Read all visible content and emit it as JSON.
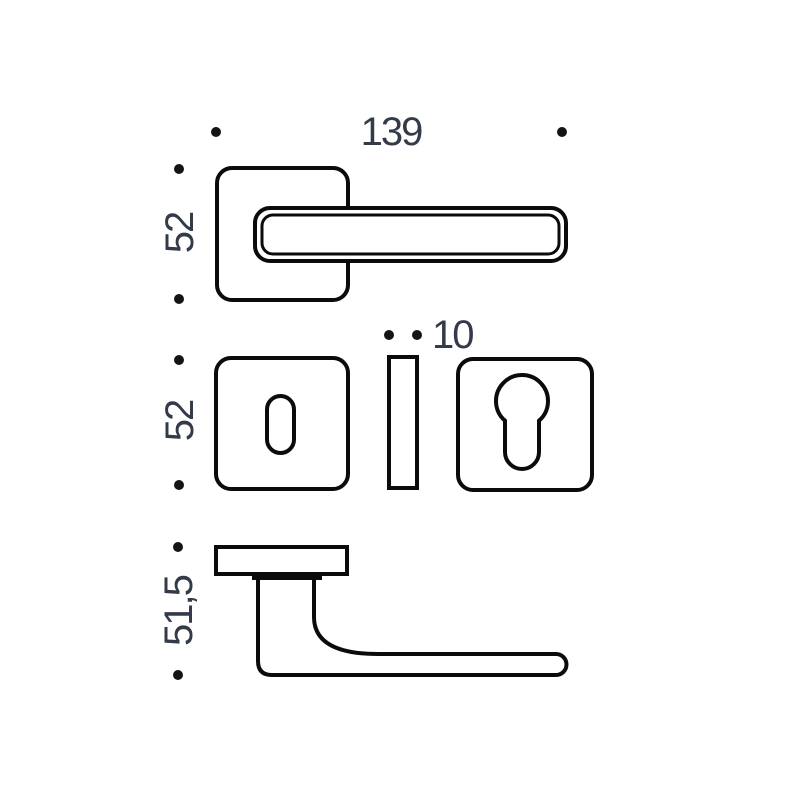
{
  "drawing": {
    "type": "technical-dimension-drawing",
    "subject": "door-lever-handle-with-square-rosette-and-escutcheons",
    "colors": {
      "background": "#ffffff",
      "line": "#0b0b0b",
      "dimension_text": "#333b49"
    },
    "views": {
      "front": {
        "width_label": "139",
        "height_label": "52"
      },
      "escutcheons": {
        "thickness_label": "10",
        "height_label": "52"
      },
      "side": {
        "height_label": "51,5"
      }
    }
  }
}
